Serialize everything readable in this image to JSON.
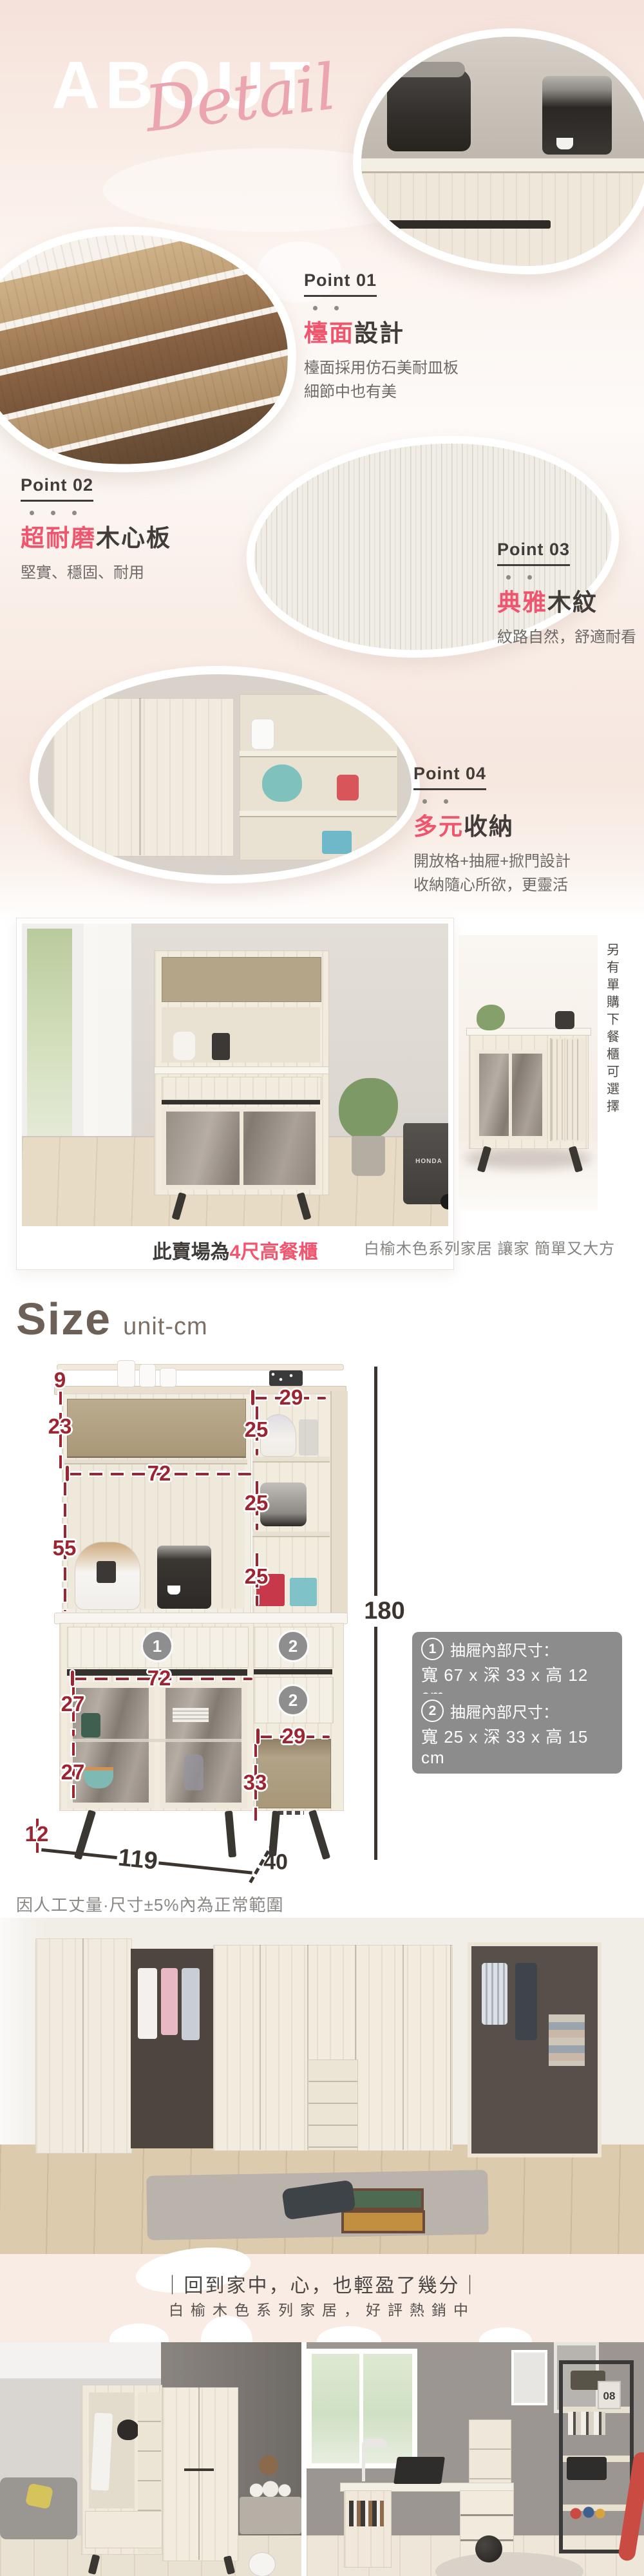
{
  "theme": {
    "accent_pink": "#f0556e",
    "script_pink": "#eaa5b0",
    "dim_red": "#9c2531",
    "dim_dark": "#3b342f",
    "bg_pink": "#f6e5de",
    "note_gray": "#8c8c8c"
  },
  "hero": {
    "about": "ABOUT",
    "script": "Detail"
  },
  "points": [
    {
      "label": "Point 01",
      "accent": "檯面",
      "rest": "設計",
      "line1": "檯面採用仿石美耐皿板",
      "line2": "細節中也有美"
    },
    {
      "label": "Point 02",
      "accent": "超耐磨",
      "rest": "木心板",
      "line1": "堅實、穩固、耐用",
      "line2": ""
    },
    {
      "label": "Point 03",
      "accent": "典雅",
      "rest": "木紋",
      "line1": "紋路自然，舒適耐看",
      "line2": ""
    },
    {
      "label": "Point 04",
      "accent": "多元",
      "rest": "收納",
      "line1": "開放格+抽屜+掀門設計",
      "line2": "收納隨心所欲，更靈活"
    }
  ],
  "showcase": {
    "vertical_note": "另有單購下餐櫃可選擇",
    "left_caption_prefix": "此賣場為",
    "left_caption_accent": "4尺高餐櫃",
    "right_caption": "白榆木色系列家居 讓家 簡單又大方"
  },
  "size": {
    "title": "Size",
    "unit": "unit-cm",
    "dims": {
      "top_board": "9",
      "hutch_door": "23",
      "inner_top_width": "72",
      "right_col_width": "29",
      "cell_a": "25",
      "cell_b": "25",
      "cell_c": "25",
      "open_height": "55",
      "inner_bottom_width": "72",
      "door_upper": "27",
      "door_lower": "27",
      "leg_height": "12",
      "niche_width": "29",
      "niche_height": "33",
      "total_width": "119",
      "total_depth": "40",
      "total_height": "180"
    },
    "badges": {
      "left_drawer": "1",
      "right_drawer_top": "2",
      "right_drawer_bottom": "2"
    },
    "notes": [
      {
        "num": "1",
        "title": "抽屜內部尺寸：",
        "dims": "寬 67 x 深 33 x 高 12 cm"
      },
      {
        "num": "2",
        "title": "抽屜內部尺寸：",
        "dims": "寬 25 x 深 33 x 高 15 cm"
      }
    ],
    "disclaimer": "因人工丈量·尺寸±5%內為正常範圍"
  },
  "footer": {
    "slogan": "｜回到家中，心，也輕盈了幾分｜",
    "series": "白榆木色系列家居，好評熱銷中"
  },
  "props": {
    "cart": "HONDA",
    "calendar": "08"
  }
}
